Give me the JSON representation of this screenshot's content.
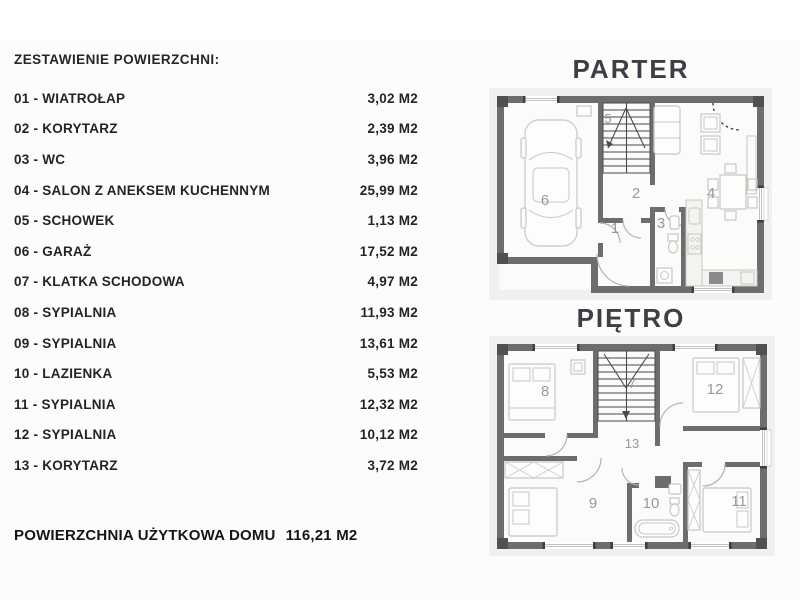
{
  "colors": {
    "wall": "#6d6d6d",
    "furniture_outline": "#c9c7c4",
    "room_number": "#97999c",
    "plan_title": "#3b4046",
    "text": "#242424"
  },
  "list": {
    "title": "ZESTAWIENIE POWIERZCHNI:",
    "rows": [
      {
        "label": "01 - WIATROŁAP",
        "area": "3,02 M2"
      },
      {
        "label": "02 - KORYTARZ",
        "area": "2,39 M2"
      },
      {
        "label": "03 - WC",
        "area": "3,96 M2"
      },
      {
        "label": "04 - SALON Z ANEKSEM KUCHENNYM",
        "area": "25,99 M2"
      },
      {
        "label": "05 - SCHOWEK",
        "area": "1,13 M2"
      },
      {
        "label": "06 - GARAŻ",
        "area": "17,52 M2"
      },
      {
        "label": "07 - KLATKA SCHODOWA",
        "area": "4,97 M2"
      },
      {
        "label": "08 - SYPIALNIA",
        "area": "11,93 M2"
      },
      {
        "label": "09 -  SYPIALNIA",
        "area": "13,61 M2"
      },
      {
        "label": "10 -  LAZIENKA",
        "area": "5,53 M2"
      },
      {
        "label": "11 -  SYPIALNIA",
        "area": "12,32 M2"
      },
      {
        "label": "12 -  SYPIALNIA",
        "area": "10,12 M2"
      },
      {
        "label": "13 - KORYTARZ",
        "area": "3,72 M2"
      }
    ],
    "total_label": "POWIERZCHNIA UŻYTKOWA DOMU",
    "total_value": "116,21 M2"
  },
  "plans": {
    "parter": {
      "title": "PARTER",
      "room_labels": {
        "entry": "1",
        "hall": "2",
        "wc": "3",
        "living": "4",
        "storage": "5",
        "garage": "6"
      }
    },
    "pietro": {
      "title": "PIĘTRO",
      "room_labels": {
        "stairs": "7",
        "bedroom_nw": "8",
        "bedroom_sw": "9",
        "bathroom": "10",
        "bedroom_se": "11",
        "bedroom_ne": "12",
        "corridor": "13"
      }
    }
  }
}
